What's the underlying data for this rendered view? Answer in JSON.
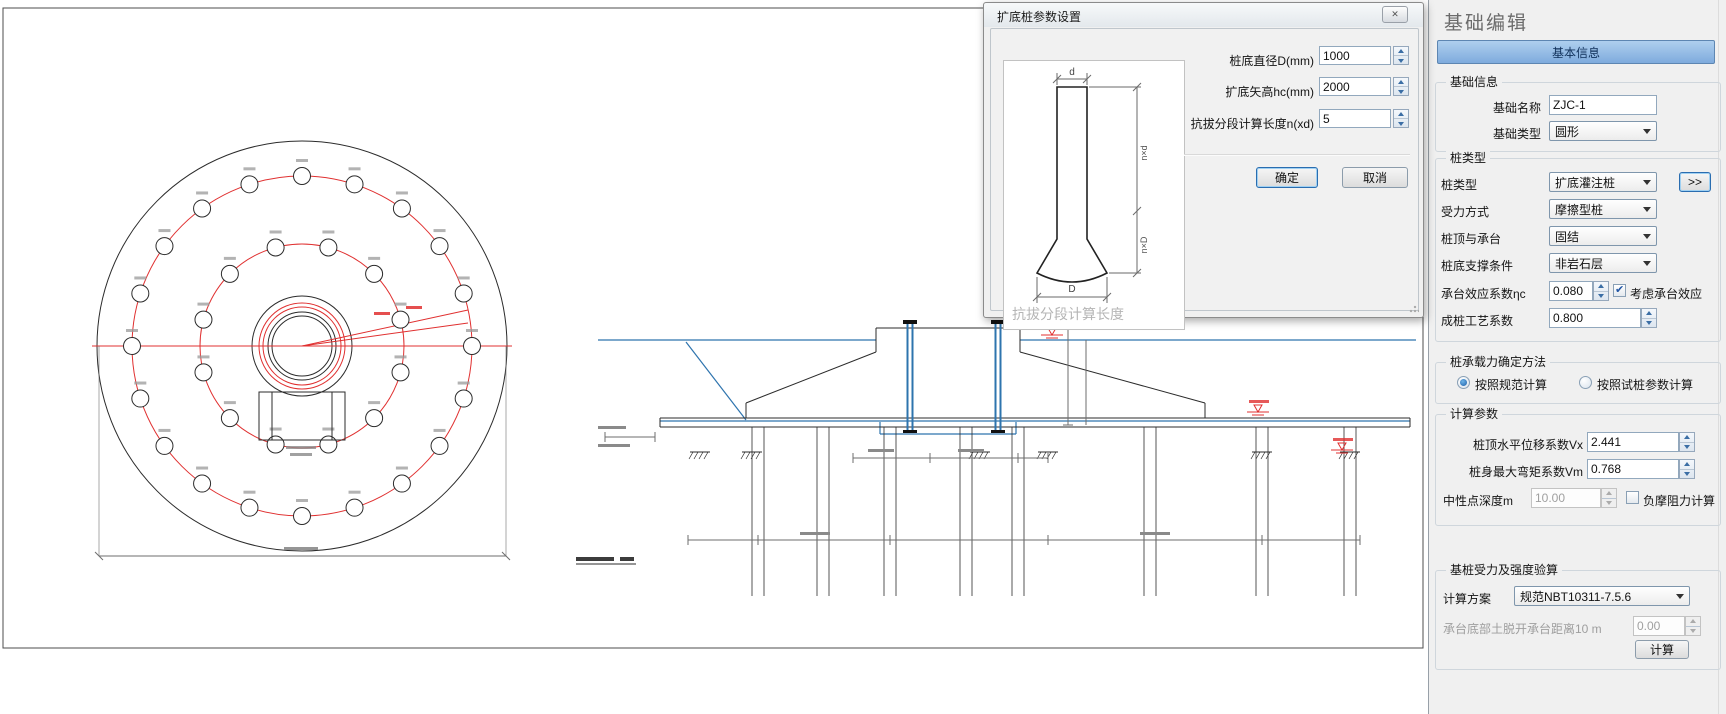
{
  "colors": {
    "line": "#2b2b2b",
    "red": "#e03030",
    "blue": "#2e74ae",
    "dim": "#6e6e6e",
    "tab_blue": "#8db9e8",
    "panel_bg": "#f0f0f0"
  },
  "dialog": {
    "title": "扩底桩参数设置",
    "close_glyph": "✕",
    "sketch": {
      "top_label": "d",
      "bottom_label": "D",
      "upper_dim_label": "n×d",
      "lower_dim_label": "n×D",
      "caption": "抗拔分段计算长度"
    },
    "fields": [
      {
        "label": "桩底直径D(mm)",
        "value": "1000"
      },
      {
        "label": "扩底矢高hc(mm)",
        "value": "2000"
      },
      {
        "label": "抗拔分段计算长度n(xd)",
        "value": "5"
      }
    ],
    "ok": "确定",
    "cancel": "取消"
  },
  "panel": {
    "title": "基础编辑",
    "tab": "基本信息",
    "info": {
      "title": "基础信息",
      "name_label": "基础名称",
      "name_value": "ZJC-1",
      "type_label": "基础类型",
      "type_value": "圆形"
    },
    "pile": {
      "title": "桩类型",
      "rows": [
        {
          "label": "桩类型",
          "value": "扩底灌注桩"
        },
        {
          "label": "受力方式",
          "value": "摩擦型桩"
        },
        {
          "label": "桩顶与承台",
          "value": "固结"
        },
        {
          "label": "桩底支撑条件",
          "value": "非岩石层"
        }
      ],
      "more": ">>",
      "eta_label": "承台效应系数ηc",
      "eta_value": "0.080",
      "eta_check": "考虑承台效应",
      "craft_label": "成桩工艺系数",
      "craft_value": "0.800"
    },
    "method": {
      "title": "桩承载力确定方法",
      "r1": "按照规范计算",
      "r2": "按照试桩参数计算"
    },
    "calc": {
      "title": "计算参数",
      "vx_label": "桩顶水平位移系数Vx",
      "vx_value": "2.441",
      "vm_label": "桩身最大弯矩系数Vm",
      "vm_value": "0.768",
      "neutral_label": "中性点深度m",
      "neutral_value": "10.00",
      "neg_check": "负摩阻力计算"
    },
    "verify": {
      "title": "基桩受力及强度验算",
      "scheme_label": "计算方案",
      "scheme_value": "规范NBT10311-7.5.6",
      "detach_label": "承台底部土脱开承台距离10 m",
      "detach_value": "0.00",
      "calc_button": "计算"
    }
  },
  "drawing": {
    "plan": {
      "cx": 302,
      "cy": 346,
      "outer_r": 205,
      "ring_outer_r": 170,
      "ring_inner_r": 102,
      "outer_pile_count": 20,
      "inner_pile_count": 12,
      "pile_r": 8.5,
      "center_rings": [
        {
          "r": 50,
          "color": "line"
        },
        {
          "r": 43,
          "color": "red"
        },
        {
          "r": 39,
          "color": "red"
        },
        {
          "r": 34,
          "color": "line"
        },
        {
          "r": 30,
          "color": "line"
        }
      ]
    },
    "section": {
      "pile_centers": [
        758,
        823,
        890,
        966,
        1018,
        1150,
        1262,
        1350
      ],
      "hatch_x": [
        700,
        752,
        980,
        1048,
        1262,
        1350
      ],
      "bolt_x": [
        910,
        998
      ],
      "level_marks": [
        [
          1025,
          324
        ],
        [
          1052,
          335
        ],
        [
          1258,
          412
        ],
        [
          1342,
          450
        ]
      ]
    }
  }
}
